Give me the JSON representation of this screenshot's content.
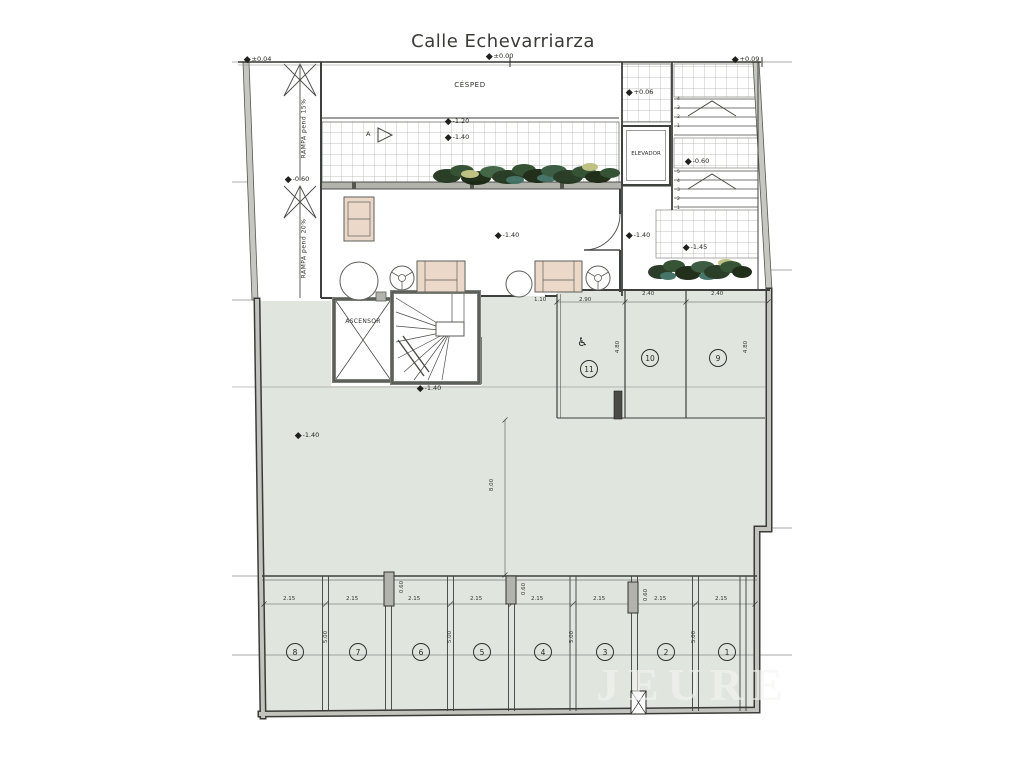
{
  "title": "Calle Echevarriarza",
  "watermark": "JEURE",
  "labels": {
    "cesped": "CÉSPED",
    "elevador": "ELEVADOR",
    "ascensor": "ASCENSOR",
    "ramp_upper": "RAMPA  pend  15%",
    "ramp_lower": "RAMPA  pend  20%",
    "section_marker": "A",
    "wheelchair_icon": "♿"
  },
  "colors": {
    "floor_green": "#e0e6de",
    "wall_gray": "#b2b3ad",
    "line_dark": "#3e403d",
    "furniture_tan": "#ecd8c8",
    "vegetation_green": "#2d4a2c",
    "vegetation_teal": "#3e6e62"
  },
  "level_markers": [
    {
      "t": "±0.00",
      "x": 487,
      "y": 52
    },
    {
      "t": "+0.09",
      "x": 733,
      "y": 55
    },
    {
      "t": "±0.04",
      "x": 245,
      "y": 55
    },
    {
      "t": "-0.60",
      "x": 286,
      "y": 175
    },
    {
      "t": "+0.06",
      "x": 627,
      "y": 88
    },
    {
      "t": "-0.60",
      "x": 686,
      "y": 157
    },
    {
      "t": "-1.20",
      "x": 446,
      "y": 117
    },
    {
      "t": "-1.40",
      "x": 446,
      "y": 133
    },
    {
      "t": "-1.40",
      "x": 496,
      "y": 231
    },
    {
      "t": "-1.40",
      "x": 627,
      "y": 231
    },
    {
      "t": "-1.45",
      "x": 684,
      "y": 243
    },
    {
      "t": "-1.40",
      "x": 418,
      "y": 384
    },
    {
      "t": "-1.40",
      "x": 296,
      "y": 431
    }
  ],
  "dimensions": [
    {
      "t": "1.10",
      "x": 534,
      "y": 297,
      "r": 0
    },
    {
      "t": "2.90",
      "x": 579,
      "y": 297,
      "r": 0
    },
    {
      "t": "2.40",
      "x": 642,
      "y": 291,
      "r": 0
    },
    {
      "t": "2.40",
      "x": 711,
      "y": 291,
      "r": 0
    },
    {
      "t": "4.80",
      "x": 612,
      "y": 344,
      "r": 1
    },
    {
      "t": "4.80",
      "x": 740,
      "y": 344,
      "r": 1
    },
    {
      "t": "8.00",
      "x": 486,
      "y": 482,
      "r": 1
    },
    {
      "t": "2.15",
      "x": 283,
      "y": 596,
      "r": 0
    },
    {
      "t": "2.15",
      "x": 346,
      "y": 596,
      "r": 0
    },
    {
      "t": "2.15",
      "x": 408,
      "y": 596,
      "r": 0
    },
    {
      "t": "2.15",
      "x": 470,
      "y": 596,
      "r": 0
    },
    {
      "t": "2.15",
      "x": 531,
      "y": 596,
      "r": 0
    },
    {
      "t": "2.15",
      "x": 593,
      "y": 596,
      "r": 0
    },
    {
      "t": "2.15",
      "x": 654,
      "y": 596,
      "r": 0
    },
    {
      "t": "2.15",
      "x": 715,
      "y": 596,
      "r": 0
    },
    {
      "t": "0.60",
      "x": 396,
      "y": 584,
      "r": 1
    },
    {
      "t": "0.60",
      "x": 518,
      "y": 586,
      "r": 1
    },
    {
      "t": "0.60",
      "x": 640,
      "y": 592,
      "r": 1
    },
    {
      "t": "5.00",
      "x": 320,
      "y": 634,
      "r": 1
    },
    {
      "t": "5.00",
      "x": 444,
      "y": 634,
      "r": 1
    },
    {
      "t": "5.00",
      "x": 566,
      "y": 634,
      "r": 1
    },
    {
      "t": "5.00",
      "x": 688,
      "y": 634,
      "r": 1
    }
  ],
  "parking_spots": [
    {
      "n": "1",
      "x": 726,
      "y": 651
    },
    {
      "n": "2",
      "x": 665,
      "y": 651
    },
    {
      "n": "3",
      "x": 604,
      "y": 651
    },
    {
      "n": "4",
      "x": 542,
      "y": 651
    },
    {
      "n": "5",
      "x": 481,
      "y": 651
    },
    {
      "n": "6",
      "x": 420,
      "y": 651
    },
    {
      "n": "7",
      "x": 357,
      "y": 651
    },
    {
      "n": "8",
      "x": 294,
      "y": 651
    },
    {
      "n": "9",
      "x": 717,
      "y": 357
    },
    {
      "n": "10",
      "x": 649,
      "y": 357
    },
    {
      "n": "11",
      "x": 588,
      "y": 368
    }
  ],
  "stair_numbers": [
    {
      "t": "4",
      "x": 677,
      "y": 97
    },
    {
      "t": "3",
      "x": 677,
      "y": 106
    },
    {
      "t": "2",
      "x": 677,
      "y": 115
    },
    {
      "t": "1",
      "x": 677,
      "y": 124
    },
    {
      "t": "5",
      "x": 677,
      "y": 170
    },
    {
      "t": "4",
      "x": 677,
      "y": 179
    },
    {
      "t": "3",
      "x": 677,
      "y": 188
    },
    {
      "t": "2",
      "x": 677,
      "y": 197
    },
    {
      "t": "1",
      "x": 677,
      "y": 206
    }
  ]
}
